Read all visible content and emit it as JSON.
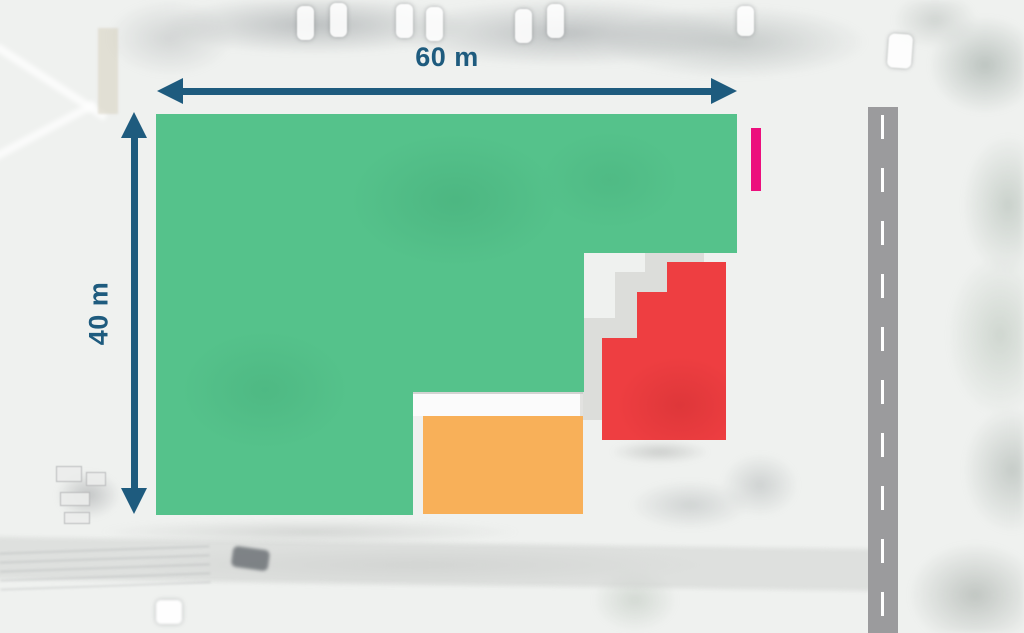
{
  "dimensions": {
    "width_label": "60 m",
    "height_label": "40 m"
  },
  "shapes": [
    {
      "name": "site-plot-area",
      "color_key": "site_green"
    },
    {
      "name": "stepped-building",
      "color_key": "building_red"
    },
    {
      "name": "annex-building",
      "color_key": "building_orange"
    },
    {
      "name": "entrance-marker",
      "color_key": "marker_pink"
    },
    {
      "name": "road",
      "color_key": "road_gray"
    }
  ],
  "colors": {
    "dimension_blue": "#1e5b7e",
    "site_green": "#55c28b",
    "building_red": "#ee3e41",
    "building_orange": "#f8b059",
    "marker_pink": "#ec0f7d",
    "road_gray": "#9b9b9d",
    "road_dash": "#ffffff"
  }
}
